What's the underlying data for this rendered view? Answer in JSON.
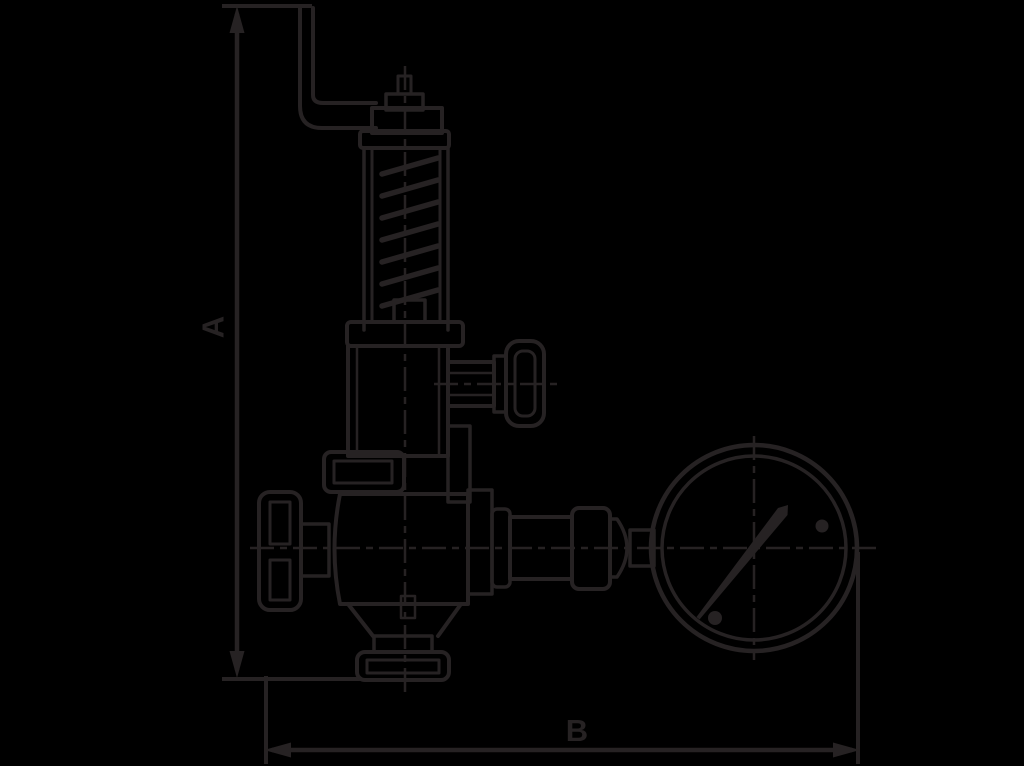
{
  "colors": {
    "background": "#000000",
    "line": "#262223"
  },
  "dimension_labels": {
    "a": "A",
    "b": "B"
  },
  "components": [
    {
      "name": "lift-lever"
    },
    {
      "name": "stem-cap"
    },
    {
      "name": "spring-bonnet"
    },
    {
      "name": "coil-spring"
    },
    {
      "name": "bonnet-flange"
    },
    {
      "name": "upper-body"
    },
    {
      "name": "side-outlet-cap"
    },
    {
      "name": "union-nut"
    },
    {
      "name": "handwheel"
    },
    {
      "name": "valve-body"
    },
    {
      "name": "bottom-outlet-flange"
    },
    {
      "name": "gauge-connection-pipe"
    },
    {
      "name": "pressure-gauge"
    }
  ]
}
